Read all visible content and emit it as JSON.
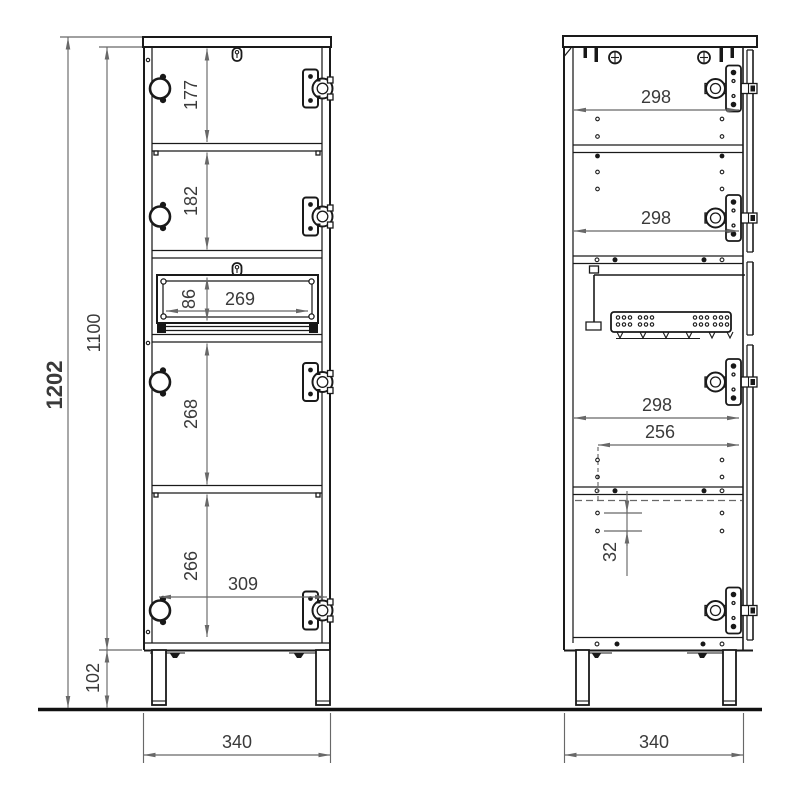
{
  "colors": {
    "background": "#ffffff",
    "object_line": "#1a1a1a",
    "dimension_line": "#686868",
    "dimension_text": "#3a3a3a",
    "ground_line": "#111111"
  },
  "front_view": {
    "dims": {
      "cabinet_height": "1202",
      "body_height": "1100",
      "leg_height": "102",
      "width": "340",
      "section_1": "177",
      "section_2": "182",
      "drawer_height": "86",
      "drawer_width": "269",
      "section_4": "268",
      "section_5": "266",
      "door_width": "309"
    }
  },
  "side_view": {
    "dims": {
      "depth_1": "298",
      "depth_2": "298",
      "depth_3": "298",
      "inner_depth": "256",
      "hole_pitch": "32",
      "width": "340"
    }
  }
}
